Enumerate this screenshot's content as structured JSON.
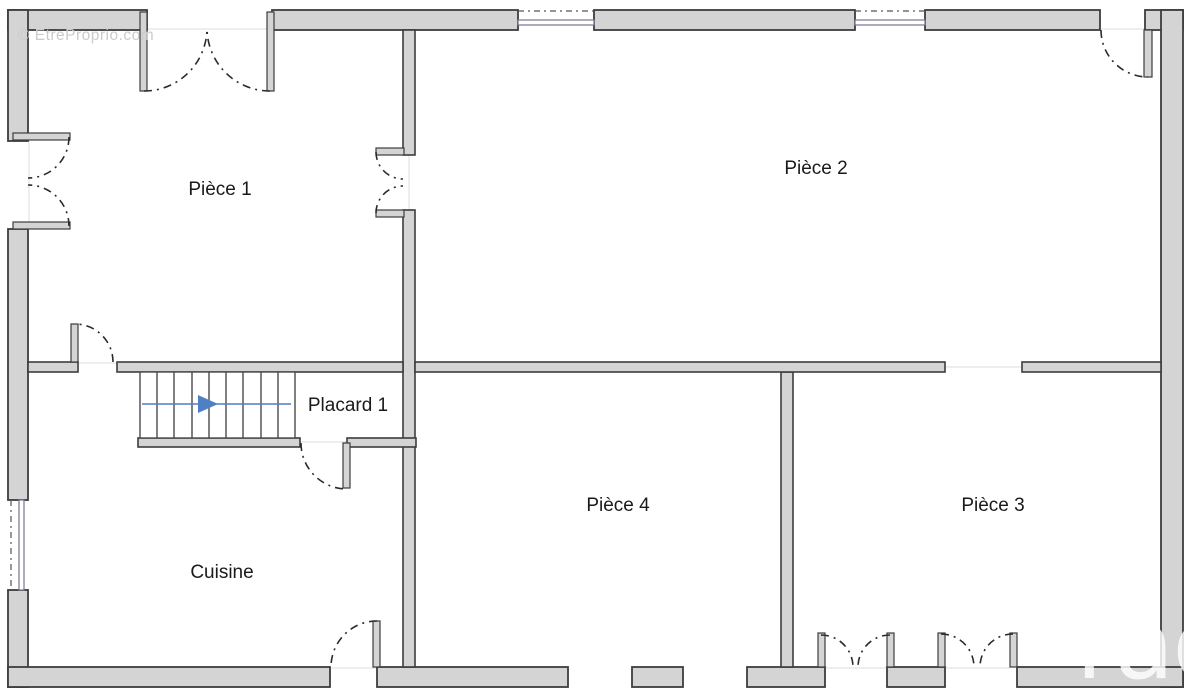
{
  "plan": {
    "type": "floor-plan",
    "watermark_top_left": "© EtreProprio.com",
    "watermark_bottom_right": "rao",
    "rooms": {
      "piece1": {
        "label": "Pièce 1"
      },
      "piece2": {
        "label": "Pièce 2"
      },
      "piece3": {
        "label": "Pièce 3"
      },
      "piece4": {
        "label": "Pièce 4"
      },
      "placard1": {
        "label": "Placard 1"
      },
      "cuisine": {
        "label": "Cuisine"
      }
    },
    "stairs": {
      "steps": 9,
      "direction_icon": "right-arrow"
    },
    "colors": {
      "wall_fill": "#d4d4d4",
      "wall_outline": "#3d3d3d",
      "door_arc": "#2b2b2b",
      "window_line": "#74748f",
      "stair_arrow": "#4f7fc4",
      "label_text": "#1a1a1a",
      "watermark": "#cbcbcb"
    }
  }
}
